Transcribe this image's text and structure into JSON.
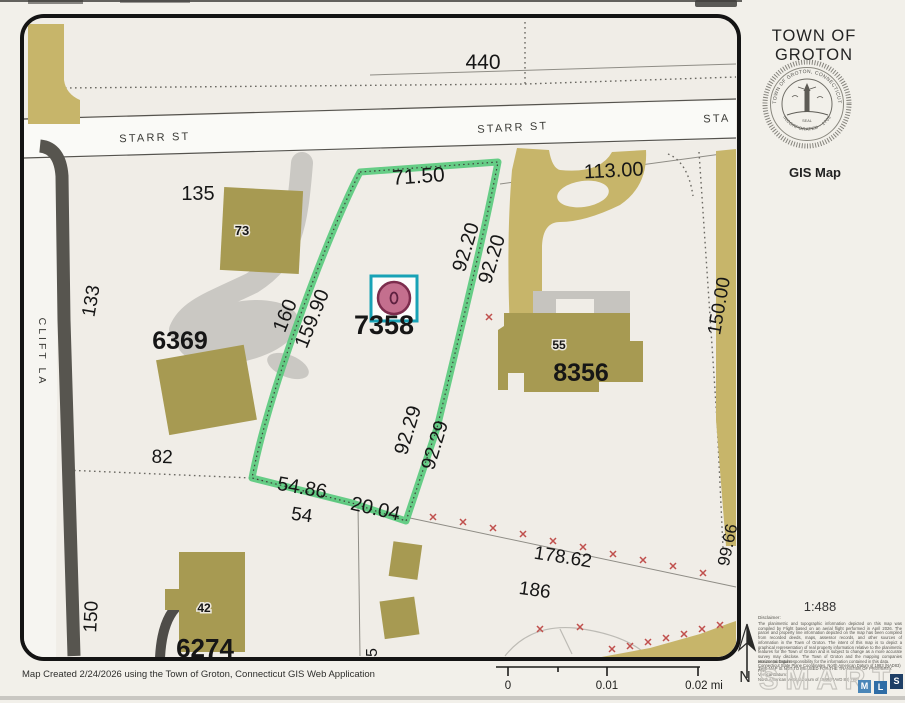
{
  "sidebar": {
    "title": "TOWN OF GROTON",
    "map_type": "GIS Map",
    "seal": {
      "ring_top": "TOWN OF GROTON, CONNECTICUT",
      "ring_bottom": "INCORPORATED · 1705",
      "center": "SEAL"
    },
    "scale_ratio": "1:488",
    "disclaimer_heading": "Disclaimer:",
    "disclaimer_body": "The planimetric and topographic information depicted on this map was compiled by Flight based on an aerial flight performed in April 2026. The parcel and property line information depicted on the map has been compiled from recorded deeds, maps, assessor records, and other sources of information in the Town of Groton. The intent of this map is to depict a graphical representation of real property information relative to the planimetric features for the Town of Groton and is subject to change as a more accurate survey may disclose. The Town of Groton and the mapping companies assume no legal responsibility for the information contained in this data.",
    "disclaimer_warning": "THIS MAP IS NOT TO BE USED FOR THE TRANSFER OF PROPERTY.",
    "horizontal_datum_label": "Horizontal Datum:",
    "horizontal_datum": "Connecticut State Plane Coordinates, North American Datum of 1983 (NAD83) Feet",
    "vertical_datum_label": "Vertical Datum:",
    "vertical_datum": "North American Vertical Datum of 1988 (NAVD 88) Feet",
    "watermark": {
      "text": "SMART",
      "sq1": "M",
      "sq2": "L",
      "sq3": "S"
    }
  },
  "footer": {
    "created": "Map Created 2/24/2026 using the Town of Groton, Connecticut GIS Web Application"
  },
  "scalebar": {
    "t0": "0",
    "t1": "0.01",
    "t2": "0.02 mi"
  },
  "north": {
    "label": "N"
  },
  "map": {
    "streets": {
      "starr_left": "STARR ST",
      "starr_center": "STARR ST",
      "starr_right": "STA",
      "clift": "CLIFT LA"
    },
    "parcel_ids": {
      "selected": "7358",
      "west": "6369",
      "east": "8356",
      "south": "6274"
    },
    "house_numbers": {
      "h73": "73",
      "h55": "55",
      "h42": "42"
    },
    "dims": {
      "d7150": "71.50",
      "d9220a": "92.20",
      "d9220b": "92.20",
      "d160": "160",
      "d15990": "159.90",
      "d9229a": "92.29",
      "d9229b": "92.29",
      "d5486": "54.86",
      "d2004": "20.04",
      "d17862": "178.62",
      "d9966": "99.66"
    },
    "lots": {
      "l440": "440",
      "l135": "135",
      "l133": "133",
      "l11300": "113.00",
      "l15000": "150.00",
      "l82": "82",
      "l54": "54",
      "l45": "45",
      "l150": "150",
      "l186": "186"
    },
    "colors": {
      "highlight_green": "#57c97b",
      "marker_pink": "#c46f8e",
      "marker_cyan": "#18a2b6",
      "building_olive": "#a79a52",
      "pavement_tan": "#c7b56a",
      "road_gray": "#57554f",
      "survey_x_red": "#c0504d"
    }
  }
}
